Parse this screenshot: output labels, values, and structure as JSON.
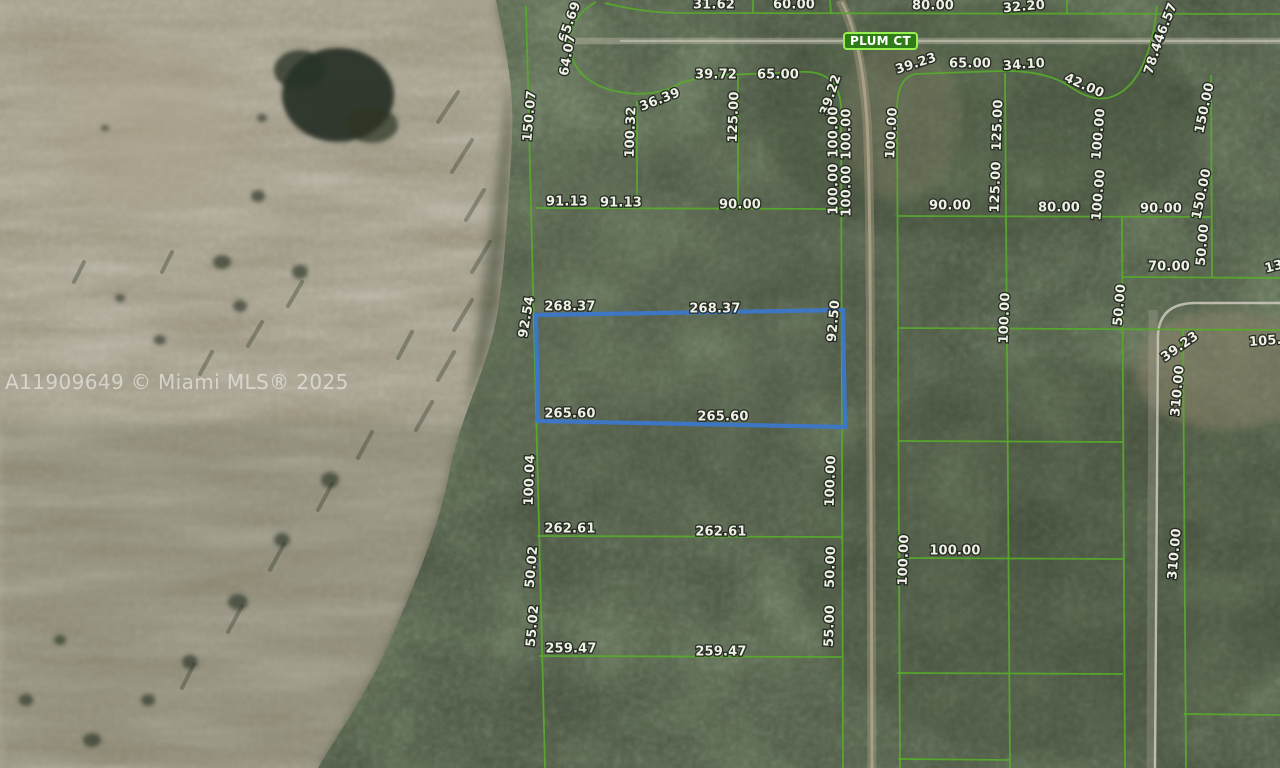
{
  "watermark": {
    "text": "A11909649 © Miami MLS® 2025"
  },
  "street": {
    "label": "PLUM CT"
  },
  "map": {
    "colors": {
      "parcel_line": "#58aa2b",
      "highlight_parcel": "#3b77cb",
      "badge_fill": "#2e7b18",
      "badge_border": "#97ef50",
      "label_fill": "#fafaf1",
      "label_outline": "#20261e"
    },
    "labels": [
      {
        "t": "31.62",
        "x": 714,
        "y": 5,
        "r": 0
      },
      {
        "t": "60.00",
        "x": 794,
        "y": 5,
        "r": 0
      },
      {
        "t": "80.00",
        "x": 933,
        "y": 6,
        "r": 0
      },
      {
        "t": "32.20",
        "x": 1024,
        "y": 7,
        "r": -5
      },
      {
        "t": "65.69",
        "x": 570,
        "y": 22,
        "r": -70
      },
      {
        "t": "64.07",
        "x": 568,
        "y": 55,
        "r": -80
      },
      {
        "t": "150.07",
        "x": 530,
        "y": 116,
        "r": -85
      },
      {
        "t": "36.39",
        "x": 660,
        "y": 100,
        "r": -21
      },
      {
        "t": "39.72",
        "x": 716,
        "y": 75,
        "r": 0
      },
      {
        "t": "65.00",
        "x": 778,
        "y": 75,
        "r": 0
      },
      {
        "t": "100.32",
        "x": 631,
        "y": 132,
        "r": -88
      },
      {
        "t": "125.00",
        "x": 734,
        "y": 117,
        "r": -88
      },
      {
        "t": "39.22",
        "x": 831,
        "y": 95,
        "r": -72
      },
      {
        "t": "100.00",
        "x": 834,
        "y": 132,
        "r": -90
      },
      {
        "t": "100.00",
        "x": 847,
        "y": 134,
        "r": -90
      },
      {
        "t": "100.00",
        "x": 834,
        "y": 189,
        "r": -90
      },
      {
        "t": "100.00",
        "x": 847,
        "y": 191,
        "r": -90
      },
      {
        "t": "91.13",
        "x": 567,
        "y": 202,
        "r": 0
      },
      {
        "t": "91.13",
        "x": 621,
        "y": 203,
        "r": 0
      },
      {
        "t": "90.00",
        "x": 740,
        "y": 205,
        "r": 0
      },
      {
        "t": "92.54",
        "x": 527,
        "y": 317,
        "r": -80
      },
      {
        "t": "268.37",
        "x": 570,
        "y": 307,
        "r": 0
      },
      {
        "t": "268.37",
        "x": 715,
        "y": 309,
        "r": 0
      },
      {
        "t": "92.50",
        "x": 834,
        "y": 321,
        "r": -85
      },
      {
        "t": "265.60",
        "x": 570,
        "y": 414,
        "r": 0
      },
      {
        "t": "265.60",
        "x": 723,
        "y": 417,
        "r": 0
      },
      {
        "t": "100.04",
        "x": 530,
        "y": 480,
        "r": -88
      },
      {
        "t": "100.00",
        "x": 831,
        "y": 481,
        "r": -88
      },
      {
        "t": "262.61",
        "x": 570,
        "y": 529,
        "r": 0
      },
      {
        "t": "262.61",
        "x": 721,
        "y": 532,
        "r": 0
      },
      {
        "t": "50.02",
        "x": 532,
        "y": 567,
        "r": -85
      },
      {
        "t": "50.00",
        "x": 831,
        "y": 567,
        "r": -88
      },
      {
        "t": "55.02",
        "x": 533,
        "y": 626,
        "r": -85
      },
      {
        "t": "55.00",
        "x": 830,
        "y": 626,
        "r": -88
      },
      {
        "t": "259.47",
        "x": 571,
        "y": 649,
        "r": 0
      },
      {
        "t": "259.47",
        "x": 721,
        "y": 652,
        "r": 0
      },
      {
        "t": "39.23",
        "x": 916,
        "y": 64,
        "r": -18
      },
      {
        "t": "65.00",
        "x": 970,
        "y": 64,
        "r": 0
      },
      {
        "t": "34.10",
        "x": 1024,
        "y": 65,
        "r": -4
      },
      {
        "t": "42.00",
        "x": 1084,
        "y": 86,
        "r": 24
      },
      {
        "t": "66.57",
        "x": 1166,
        "y": 23,
        "r": -68
      },
      {
        "t": "78.44",
        "x": 1155,
        "y": 54,
        "r": -72
      },
      {
        "t": "100.00",
        "x": 892,
        "y": 133,
        "r": -87
      },
      {
        "t": "125.00",
        "x": 998,
        "y": 125,
        "r": -88
      },
      {
        "t": "100.00",
        "x": 1099,
        "y": 134,
        "r": -85
      },
      {
        "t": "150.00",
        "x": 1205,
        "y": 108,
        "r": -78
      },
      {
        "t": "125.00",
        "x": 996,
        "y": 187,
        "r": -88
      },
      {
        "t": "100.00",
        "x": 1099,
        "y": 195,
        "r": -85
      },
      {
        "t": "150.00",
        "x": 1202,
        "y": 194,
        "r": -78
      },
      {
        "t": "90.00",
        "x": 950,
        "y": 206,
        "r": 0
      },
      {
        "t": "80.00",
        "x": 1059,
        "y": 208,
        "r": 0
      },
      {
        "t": "90.00",
        "x": 1161,
        "y": 209,
        "r": 0
      },
      {
        "t": "50.00",
        "x": 1203,
        "y": 245,
        "r": -85
      },
      {
        "t": "70.00",
        "x": 1169,
        "y": 267,
        "r": 0
      },
      {
        "t": "13",
        "x": 1274,
        "y": 267,
        "r": -15
      },
      {
        "t": "100.00",
        "x": 1005,
        "y": 318,
        "r": -88
      },
      {
        "t": "50.00",
        "x": 1120,
        "y": 305,
        "r": -85
      },
      {
        "t": "39.23",
        "x": 1180,
        "y": 347,
        "r": -35
      },
      {
        "t": "310.00",
        "x": 1178,
        "y": 391,
        "r": -85
      },
      {
        "t": "105.0",
        "x": 1270,
        "y": 341,
        "r": -4
      },
      {
        "t": "100.00",
        "x": 904,
        "y": 560,
        "r": -88
      },
      {
        "t": "100.00",
        "x": 955,
        "y": 551,
        "r": 0
      },
      {
        "t": "310.00",
        "x": 1175,
        "y": 554,
        "r": -85
      }
    ],
    "boundaries": [
      {
        "cls": "road",
        "d": "M575,41 L1280,41"
      },
      {
        "cls": "road-core",
        "d": "M620,41 L1280,41"
      },
      {
        "cls": "dirt",
        "d": "M840,0 C856,30 863,70 867,120 C871,200 870,350 871,480 L872,768"
      },
      {
        "cls": "dirt-core",
        "d": "M842,2 C857,32 864,72 867,122 C871,202 870,352 871,482 L872,768"
      },
      {
        "cls": "gray-band",
        "d": "M1153,310 L1151,768"
      },
      {
        "cls": "gray",
        "d": "M1280,303 L1196,303 Q1159,303 1158,336 L1155,768"
      },
      {
        "cls": "green",
        "d": "M526,6 L545,768"
      },
      {
        "cls": "green",
        "d": "M596,2 C574,14 566,34 571,54 C577,78 600,90 627,93 C650,96 670,90 680,83"
      },
      {
        "cls": "green",
        "d": "M680,83 C702,77 712,76 726,75 L798,72 C826,70 839,82 841,106"
      },
      {
        "cls": "green",
        "d": "M841,106 L843,768"
      },
      {
        "cls": "green",
        "d": "M637,101 L637,208"
      },
      {
        "cls": "green",
        "d": "M738,77 L738,208"
      },
      {
        "cls": "green",
        "d": "M536,208 L843,209"
      },
      {
        "cls": "green",
        "d": "M537,536 L842,537"
      },
      {
        "cls": "green",
        "d": "M539,656 L842,657"
      },
      {
        "cls": "green",
        "d": "M897,673 L1123,674"
      },
      {
        "cls": "green",
        "d": "M898,759 L1010,760"
      },
      {
        "cls": "green",
        "d": "M605,3 C628,9 650,12 672,13 L1280,14"
      },
      {
        "cls": "green",
        "d": "M753,0 L753,13"
      },
      {
        "cls": "green",
        "d": "M830,0 L831,13"
      },
      {
        "cls": "green",
        "d": "M1067,0 L1067,14"
      },
      {
        "cls": "green",
        "d": "M915,74 Q897,78 897,110 L900,768"
      },
      {
        "cls": "green",
        "d": "M915,74 L1000,71"
      },
      {
        "cls": "green",
        "d": "M1000,71 C1032,70 1056,77 1069,86 C1086,98 1102,102 1116,95 C1140,84 1153,48 1157,6"
      },
      {
        "cls": "green",
        "d": "M1005,73 L1010,768"
      },
      {
        "cls": "green",
        "d": "M1122,216 L1125,768"
      },
      {
        "cls": "green",
        "d": "M1183,329 L1186,768"
      },
      {
        "cls": "green",
        "d": "M1211,75 L1212,277"
      },
      {
        "cls": "green",
        "d": "M897,216 L1212,217"
      },
      {
        "cls": "green",
        "d": "M1123,277 L1280,278"
      },
      {
        "cls": "green",
        "d": "M898,328 L1280,330"
      },
      {
        "cls": "green",
        "d": "M898,441 L1123,442"
      },
      {
        "cls": "green",
        "d": "M898,558 L1123,559"
      },
      {
        "cls": "green",
        "d": "M1184,714 L1280,715"
      },
      {
        "cls": "blue",
        "d": "M536,315 L843,310 L845,427 L538,421 Z"
      }
    ]
  }
}
